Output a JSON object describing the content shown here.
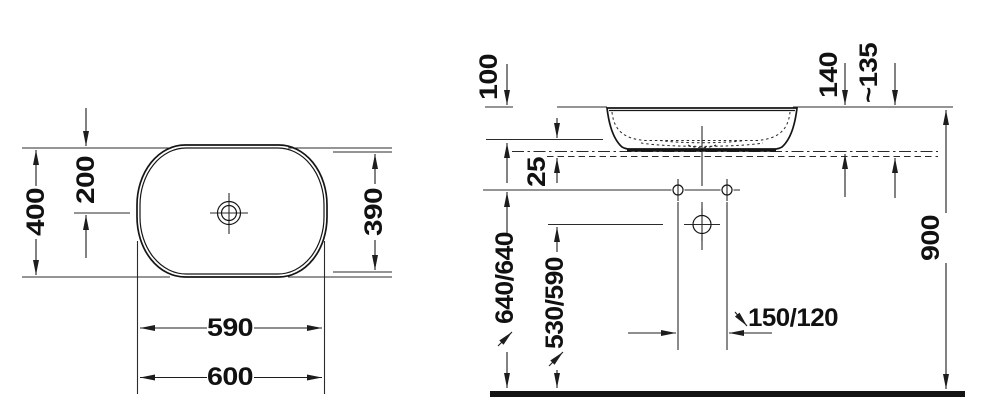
{
  "drawing": {
    "top_view": {
      "overall_depth": "400",
      "center_depth": "200",
      "inner_depth": "390",
      "inner_width": "590",
      "overall_width": "600"
    },
    "side_view": {
      "bowl_depth": "100",
      "base_gap": "25",
      "total_height": "140",
      "installed_height": "~135",
      "faucet_height": "640/640",
      "drain_height": "530/590",
      "faucet_offset": "150/120",
      "rim_height": "900"
    }
  }
}
